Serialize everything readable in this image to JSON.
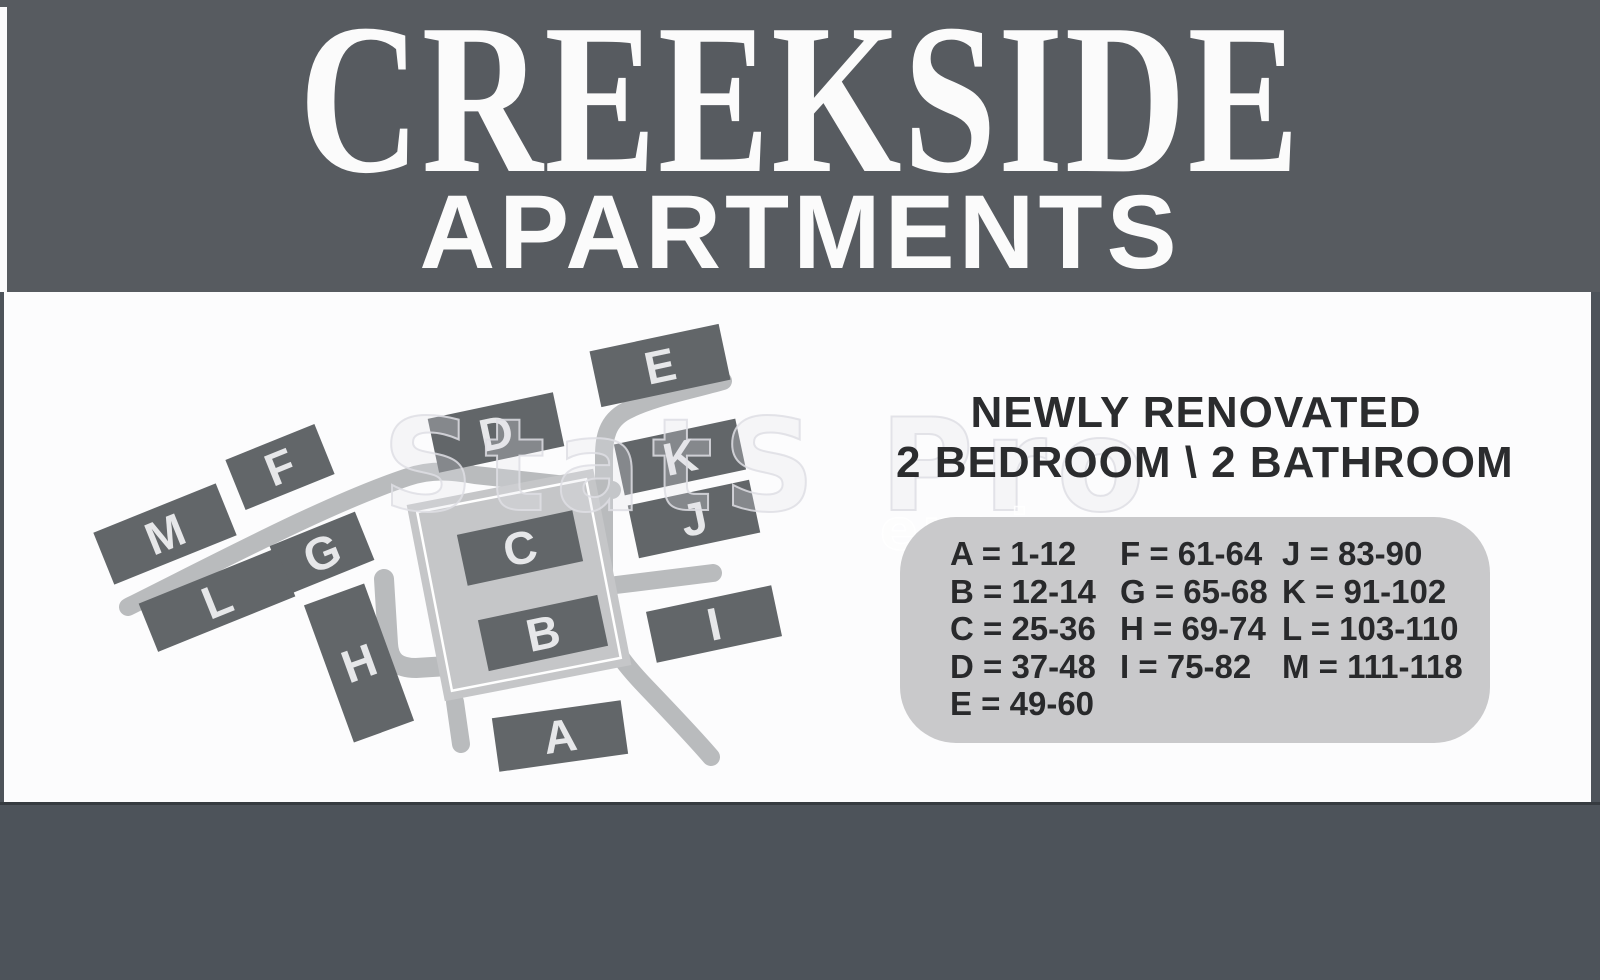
{
  "header": {
    "title": "CREEKSIDE",
    "subtitle": "APARTMENTS"
  },
  "promo": {
    "line1": "NEWLY RENOVATED",
    "line2": "2 BEDROOM \\ 2 BATHROOM"
  },
  "legend": {
    "columns": [
      [
        "A = 1-12",
        "B = 12-14",
        "C = 25-36",
        "D = 37-48",
        "E = 49-60"
      ],
      [
        "F = 61-64",
        "G = 65-68",
        "H = 69-74",
        "I = 75-82"
      ],
      [
        "J = 83-90",
        "K = 91-102",
        "L = 103-110",
        "M = 111-118"
      ]
    ]
  },
  "map": {
    "buildings": [
      {
        "label": "A",
        "x": 560,
        "y": 736,
        "w": 130,
        "h": 54,
        "rot": -8
      },
      {
        "label": "B",
        "x": 543,
        "y": 633,
        "w": 122,
        "h": 52,
        "rot": -12
      },
      {
        "label": "C",
        "x": 520,
        "y": 548,
        "w": 118,
        "h": 52,
        "rot": -12
      },
      {
        "label": "D",
        "x": 496,
        "y": 432,
        "w": 128,
        "h": 55,
        "rot": -12
      },
      {
        "label": "E",
        "x": 660,
        "y": 365,
        "w": 132,
        "h": 57,
        "rot": -12
      },
      {
        "label": "F",
        "x": 280,
        "y": 467,
        "w": 96,
        "h": 54,
        "rot": -22
      },
      {
        "label": "G",
        "x": 322,
        "y": 553,
        "w": 92,
        "h": 52,
        "rot": -22
      },
      {
        "label": "H",
        "x": 359,
        "y": 663,
        "w": 64,
        "h": 146,
        "rot": -20
      },
      {
        "label": "I",
        "x": 714,
        "y": 624,
        "w": 128,
        "h": 52,
        "rot": -12
      },
      {
        "label": "J",
        "x": 694,
        "y": 519,
        "w": 124,
        "h": 54,
        "rot": -12
      },
      {
        "label": "K",
        "x": 680,
        "y": 457,
        "w": 124,
        "h": 52,
        "rot": -12
      },
      {
        "label": "L",
        "x": 217,
        "y": 600,
        "w": 148,
        "h": 52,
        "rot": -22
      },
      {
        "label": "M",
        "x": 165,
        "y": 534,
        "w": 132,
        "h": 56,
        "rot": -22
      }
    ]
  },
  "watermark": {
    "text1": "StatS Pro",
    "text2": "engine"
  },
  "colors": {
    "header_bg": "#575b60",
    "footer_bg": "#4d535a",
    "panel_bg": "#fcfcfd",
    "building_fill": "#626669",
    "building_letter": "#e6e7e9",
    "road": "#b9bbbd",
    "parking_lot": "#c5c6c8",
    "legend_bg": "#c9c9cb",
    "text_dark": "#2b2c2e",
    "title_text": "#fbfbfb"
  }
}
